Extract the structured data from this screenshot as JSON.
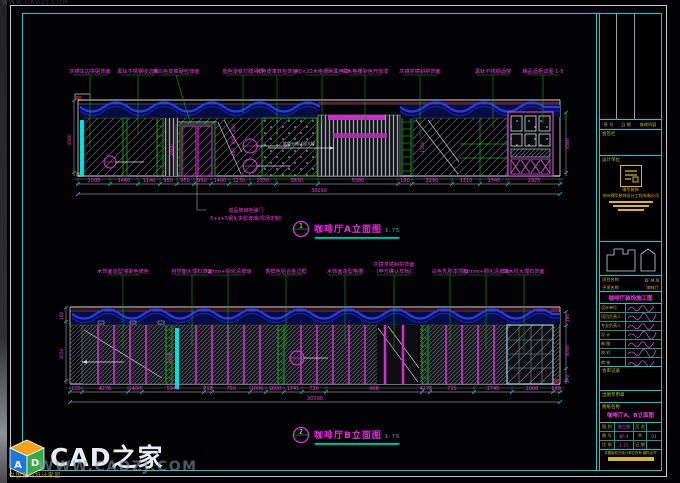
{
  "watermark": {
    "top": "WWW.CADZJ.COM",
    "bottom": "WWW.CADZJ.COM"
  },
  "logo": {
    "brand": "CAD之家",
    "cube_left": "A",
    "cube_right": "D",
    "site_caption": "中国室内设计家园"
  },
  "colors": {
    "accent_cyan": "#17c9c9",
    "annotation_magenta": "#ef3ae0",
    "leader_green": "#15a015",
    "wave_blue": "#2a3cee",
    "titleblock_yellow": "#d8b43c"
  },
  "elevA": {
    "title": {
      "num": "1",
      "text": "咖啡厅A立面图",
      "scale": "1:75"
    },
    "callouts": [
      "灰镜车边拼贴饰面",
      "黑钛不锈钢收边条",
      "米白色皮革硬包饰面",
      "蓝色渐变灯膜吊顶",
      "米色皮革软包饰面",
      "40×20木格栅刷黑色漆",
      "实木格栅染色开放漆",
      "灰镜茶镜斜拼饰面",
      "黑钛不锈钢酒架",
      "精品酒柜详图 1-5"
    ],
    "inline_note": "软包分格详见大样",
    "door_note_1": "成品玻璃地弹门",
    "door_note_2": "5+o+5钢化夹胶玻璃(现场定制)",
    "dims": [
      "1008",
      "1460",
      "1140",
      "950",
      "950",
      "950",
      "1400",
      "1230",
      "2350",
      "3830",
      "5380",
      "190",
      "3290",
      "1310",
      "1545",
      "2925"
    ],
    "overall": "30090",
    "vdims": {
      "left": "3580",
      "door": "2400",
      "right": "3580",
      "slat": "1500",
      "stack": [
        "150",
        "800",
        "600"
      ]
    }
  },
  "elevB": {
    "title": {
      "num": "2",
      "text": "咖啡厅B立面图",
      "scale": "1:75"
    },
    "callouts": [
      "木饰面造型墙染色修色",
      "自然面大理石饰面",
      "72mm+钢化清玻璃",
      "香槟色铝合金边框",
      "木饰面造型格栅",
      "灰镜茶镜斜拼饰面",
      "白色乳胶漆顶面",
      "72mm+钢化清玻璃",
      "灰木纹大理石饰面"
    ],
    "callout6_line2": "(甲方确认样板)",
    "dims": [
      "115",
      "4276",
      "1480",
      "5945",
      "718",
      "750",
      "1006",
      "1600",
      "1741",
      "730",
      "908",
      "4276",
      "715",
      "1745",
      "1008",
      "180"
    ],
    "overall": "30090",
    "vdims": {
      "left_top": "160",
      "left": "3050",
      "right_top": "180",
      "right_mid": "3050",
      "right_bot": "370",
      "strip": "2400"
    }
  },
  "titleblock": {
    "rev_headers": [
      "序 号",
      "日 期",
      "修改内容"
    ],
    "sign_label": "会签栏",
    "unit_label": "设计单位",
    "stamp_caption": "锦华装饰",
    "company": "徐州锦华装饰设计工程有限公司",
    "project_rows": [
      {
        "label": "项目名称",
        "value": "KF·M.N"
      },
      {
        "label": "子项名称",
        "value": "咖啡厅"
      }
    ],
    "project_title": "咖啡厅装饰施工图",
    "sig_labels": [
      "设计单位",
      "项目负责人",
      "专业负责人",
      "设 计",
      "制 图",
      "校 对",
      "审 核"
    ],
    "review_label": "会审记录",
    "seal_label": "出图专用章",
    "sheet_name_label": "图纸名称",
    "sheet_name": "咖啡厅A、B立面图",
    "table": {
      "rows": [
        [
          "图 别",
          "施工图",
          "页 次",
          ""
        ],
        [
          "图 号",
          "KF-4",
          "共",
          "04"
        ],
        [
          "比 例",
          "1:75",
          "日 期",
          ""
        ]
      ]
    },
    "note": "本图版权归设计单位所有 翻印必究"
  }
}
